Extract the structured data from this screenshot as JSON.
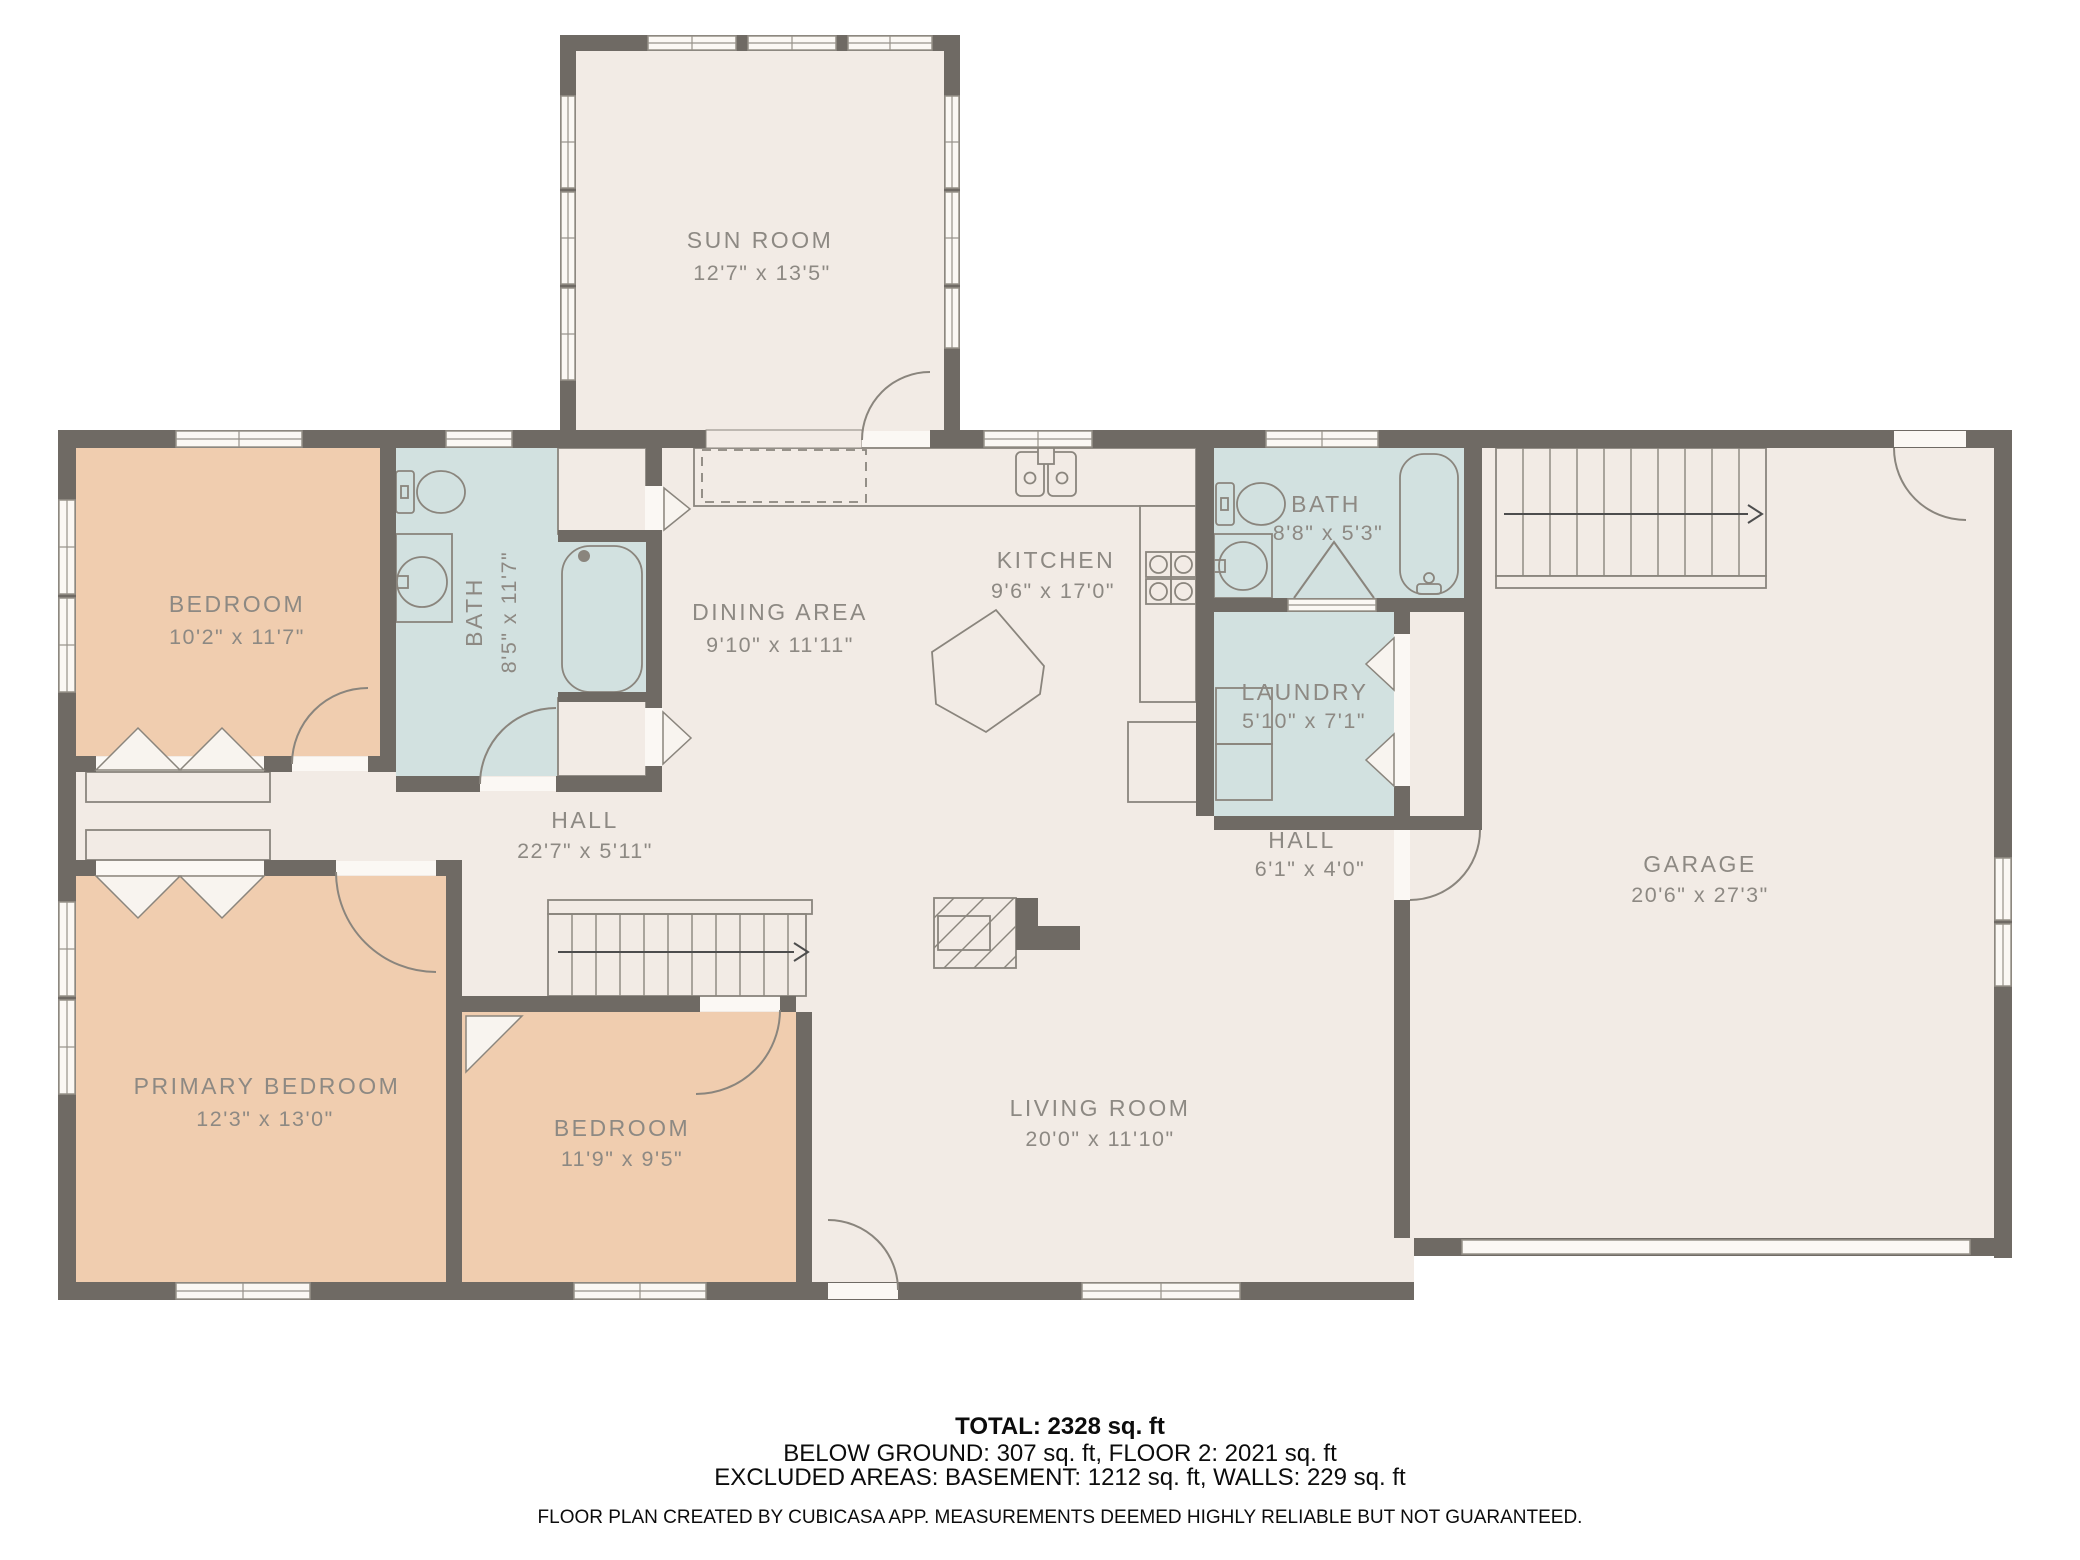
{
  "plan": {
    "rooms": {
      "sun_room": {
        "name": "SUN ROOM",
        "dims": "12'7\" x 13'5\""
      },
      "bedroom_top": {
        "name": "BEDROOM",
        "dims": "10'2\" x 11'7\""
      },
      "bath_left": {
        "name": "BATH",
        "dims": "8'5\" x 11'7\""
      },
      "dining": {
        "name": "DINING AREA",
        "dims": "9'10\" x 11'11\""
      },
      "kitchen": {
        "name": "KITCHEN",
        "dims": "9'6\" x 17'0\""
      },
      "bath_right": {
        "name": "BATH",
        "dims": "8'8\" x 5'3\""
      },
      "laundry": {
        "name": "LAUNDRY",
        "dims": "5'10\" x 7'1\""
      },
      "hall_main": {
        "name": "HALL",
        "dims": "22'7\" x 5'11\""
      },
      "hall_small": {
        "name": "HALL",
        "dims": "6'1\" x 4'0\""
      },
      "garage": {
        "name": "GARAGE",
        "dims": "20'6\" x 27'3\""
      },
      "primary_bedroom": {
        "name": "PRIMARY BEDROOM",
        "dims": "12'3\" x 13'0\""
      },
      "bedroom_bottom": {
        "name": "BEDROOM",
        "dims": "11'9\" x 9'5\""
      },
      "living_room": {
        "name": "LIVING ROOM",
        "dims": "20'0\" x 11'10\""
      }
    },
    "colors": {
      "wall": "#6f6a64",
      "floor": "#f2ebe5",
      "bedroom_fill": "#f0cdaf",
      "wet_room_fill": "#d2e1e0",
      "label_text": "#8d8983"
    },
    "footer": {
      "total": "TOTAL: 2328 sq. ft",
      "areas": "BELOW GROUND: 307 sq. ft, FLOOR 2: 2021 sq. ft",
      "excluded": "EXCLUDED AREAS: BASEMENT: 1212 sq. ft, WALLS: 229 sq. ft",
      "disclaimer": "FLOOR PLAN CREATED BY CUBICASA APP. MEASUREMENTS DEEMED HIGHLY RELIABLE BUT NOT GUARANTEED."
    }
  }
}
